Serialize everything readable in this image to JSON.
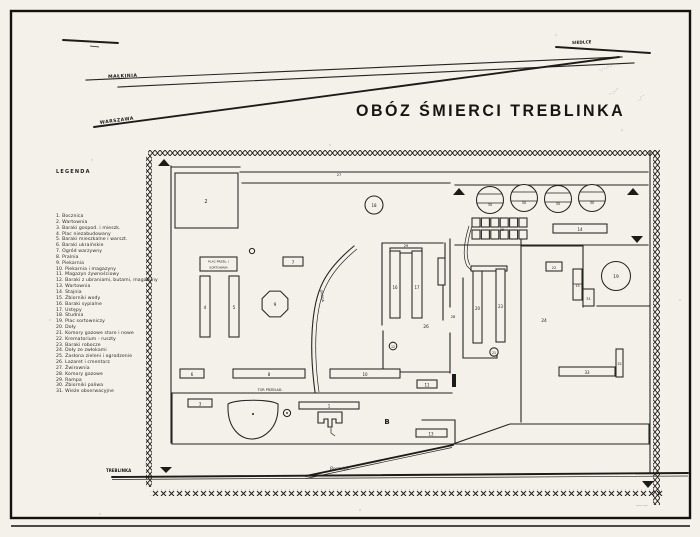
{
  "title": {
    "text": "OBÓZ ŚMIERCI TREBLINKA"
  },
  "legend": {
    "heading": "LEGENDA",
    "items": [
      "1. Bocznica",
      "2. Wartownia",
      "3. Baraki gospod. i mieszk.",
      "4. Plac niezabudowany",
      "5. Baraki mieszkalne i warszt.",
      "6. Baraki ukraińskie",
      "7. Ogród warzywny",
      "8. Pralnia",
      "9. Piekarnia",
      "10. Piekarnia i magazyny",
      "11. Magazyn żywnościowy",
      "12. Baraki z ubraniami, butami, magazyny",
      "13. Wartownia",
      "14. Stajnia",
      "15. Zbiorniki wody",
      "16. Baraki sypialne",
      "17. Ustępy",
      "18. Studnia",
      "19. Plac sortowniczy",
      "20. Doły",
      "21. Komory gazowe stare i nowe",
      "22. Krematorium - ruszty",
      "23. Baraki robocze",
      "24. Doły ze zwłokami",
      "25. Zasłona zieleni i ogrodzenie",
      "26. Lazaret i cmentarz",
      "27. Żwirownia",
      "28. Komory gazowe",
      "29. Rampa",
      "30. Zbiorniki paliwa",
      "31. Wieże obserwacyjne"
    ]
  },
  "railways": {
    "malkinia_label": "MAŁKINIA",
    "warszawa_label": "WARSZAWA",
    "siedlce_label": "SIEDLCE",
    "station_label": "TREBLINKA",
    "bocznica_label": "Bocznica"
  },
  "annotations": {
    "scribble1": "·.··.··.·",
    "scribble2": "··.·.··",
    "scribble3": "·.··.",
    "scribble4": "····",
    "scribble5": "—···—"
  },
  "map": {
    "sort_box_line1": "PLAC PRZEŁ. I",
    "sort_box_line2": "SORTOWNIA",
    "road_label": "DROGA",
    "platform_label": "TOR PRZEŁAD.",
    "letter_b": "B",
    "labels": {
      "b1": "1",
      "b2": "2",
      "b3": "3",
      "b4": "4",
      "b5": "5",
      "b6": "6",
      "b7": "7",
      "b8": "8",
      "b9": "9",
      "b10": "10",
      "b11": "11",
      "b12": "12",
      "b13": "13",
      "b14": "14",
      "b15": "15",
      "b16": "16",
      "b17": "17",
      "b18": "18",
      "b19": "19",
      "b20": "20",
      "b21": "21",
      "b22": "22",
      "b23": "23",
      "b24": "24",
      "b25": "25",
      "b26": "26",
      "b27": "27",
      "b28": "28",
      "b29": "29",
      "b31": "31",
      "b32": "32",
      "b33": "33",
      "tank": "30"
    }
  },
  "colors": {
    "ink": "#262420",
    "paper": "#f4f1ea"
  }
}
